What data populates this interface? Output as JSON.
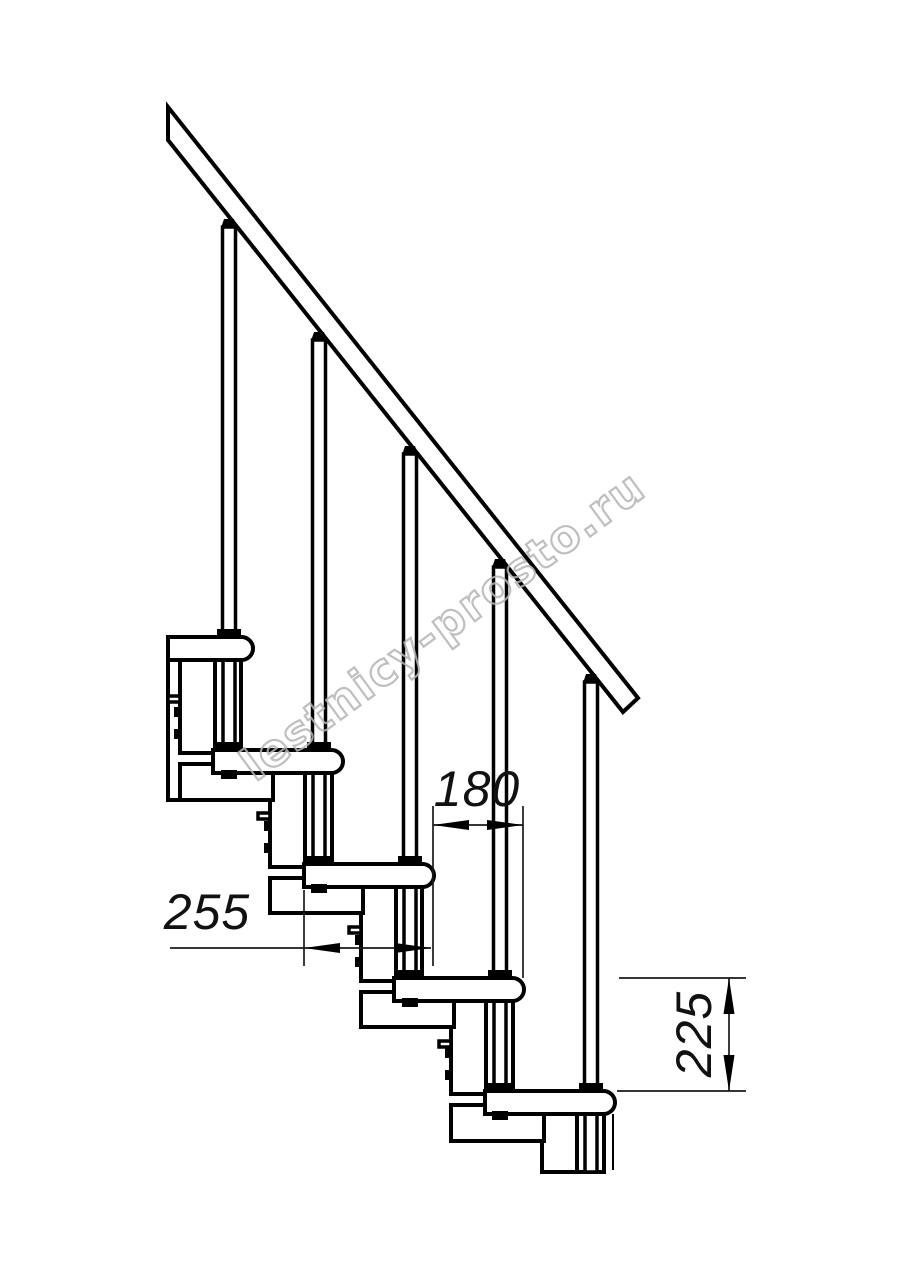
{
  "drawing": {
    "dimensions": {
      "going": {
        "value": "180"
      },
      "tread_depth": {
        "value": "255"
      },
      "rise": {
        "value": "225"
      }
    },
    "watermark": {
      "text": "lestnicy-prosto.ru"
    },
    "colors": {
      "line": "#000000",
      "dimension": "#1a1a1a",
      "watermark": "#b5b5b5",
      "background": "#ffffff"
    }
  }
}
